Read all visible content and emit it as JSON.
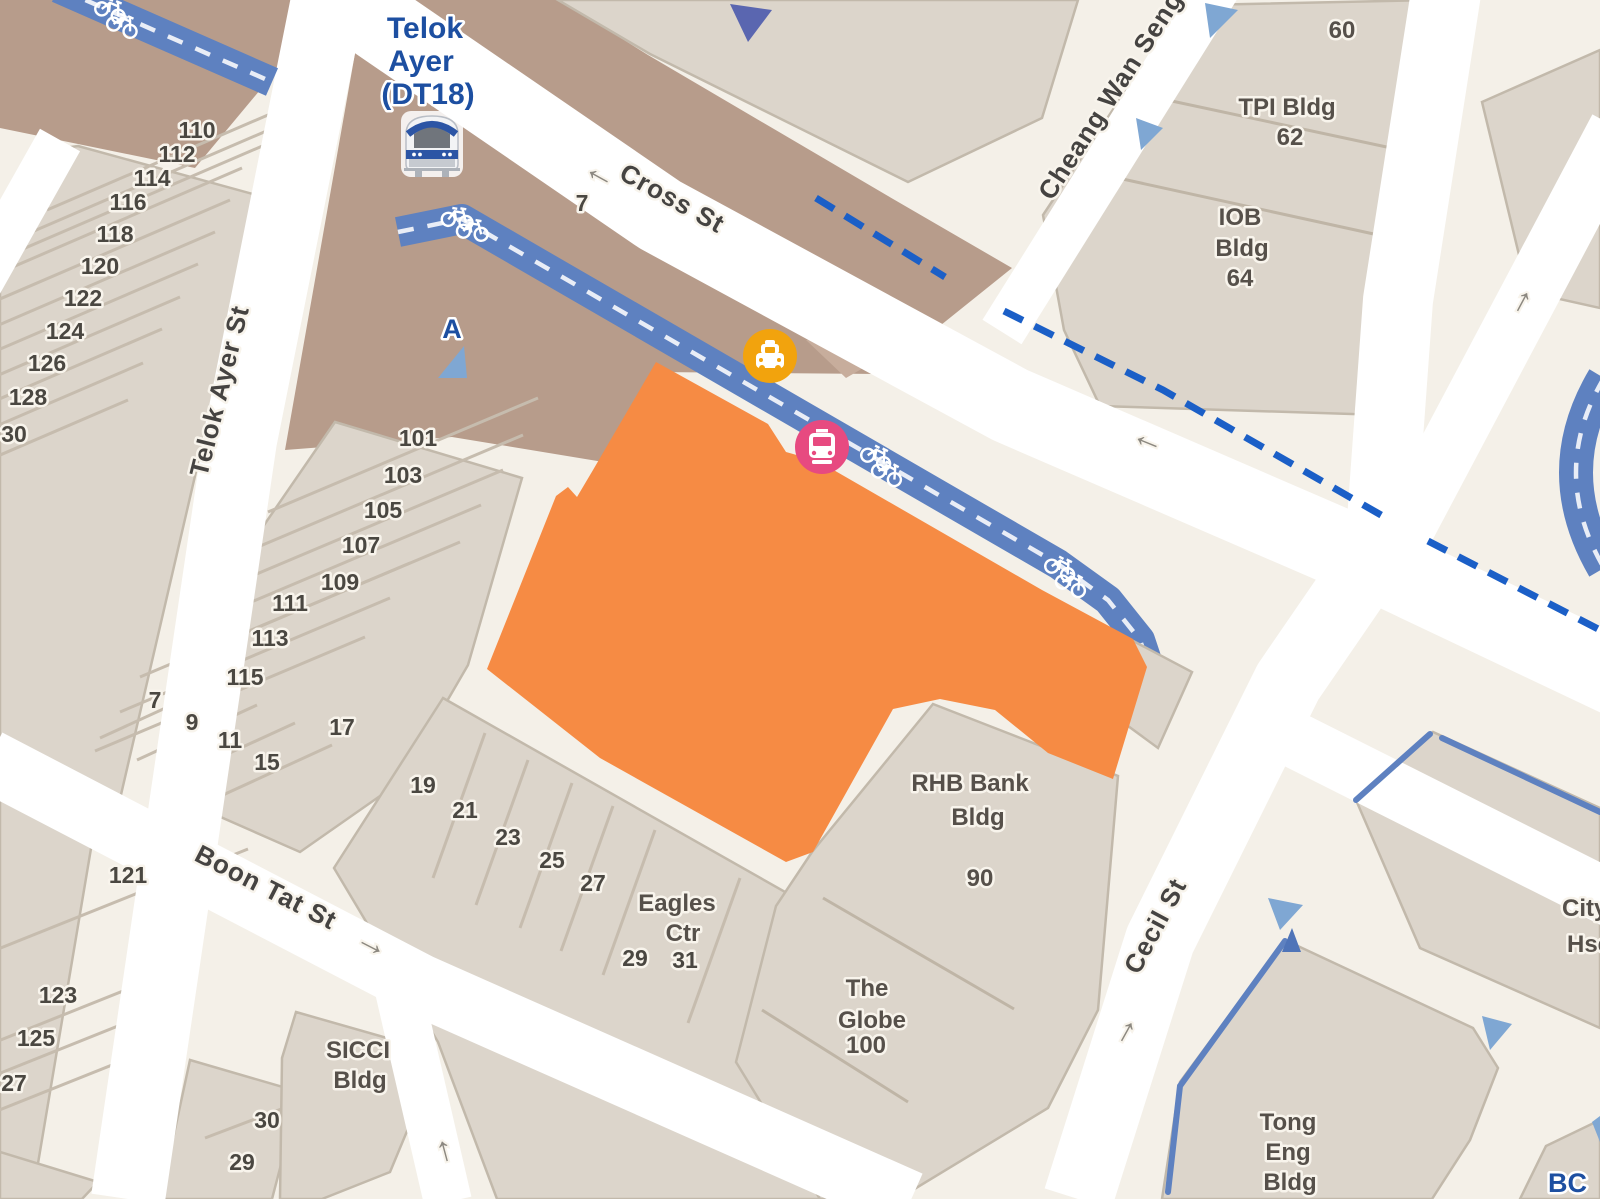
{
  "map": {
    "colors": {
      "background": "#F4F0E8",
      "road": "#FFFFFF",
      "pedestrian_zone": "#B79C8B",
      "building_fill": "#DCD5CB",
      "building_outline": "#C2B9AB",
      "highlight_parcel": "#F68B44",
      "cycleway": "#5E81C0",
      "rail_dashed_line": "#1B5FC7",
      "street_label": "#454341",
      "station_label": "#1D4FA1",
      "taxi_icon_bg": "#F2A30D",
      "bus_icon_bg": "#E74A80",
      "entrance_marker": "#7FA7D3"
    },
    "station": {
      "lines": [
        "Telok",
        "Ayer",
        "(DT18)"
      ]
    },
    "streets": {
      "telok_ayer": "Telok Ayer St",
      "cross": "Cross St",
      "cheang": "Cheang Wan Seng",
      "boon_tat": "Boon Tat St",
      "cecil": "Cecil St"
    },
    "cross_number": "7",
    "numbers_west": [
      "110",
      "112",
      "114",
      "116",
      "118",
      "120",
      "122",
      "124",
      "126",
      "128",
      "30"
    ],
    "numbers_east": [
      "101",
      "103",
      "105",
      "107",
      "109",
      "111",
      "113",
      "115"
    ],
    "numbers_small": [
      "7",
      "9",
      "11",
      "15",
      "17"
    ],
    "numbers_north_boon": [
      "19",
      "21",
      "23",
      "25",
      "27",
      "29",
      "31"
    ],
    "numbers_south_boon": [
      "121",
      "123",
      "125",
      "27",
      "30",
      "29"
    ],
    "buildings": {
      "b60": [
        "60"
      ],
      "tpi": [
        "TPI Bldg",
        "62"
      ],
      "iob": [
        "IOB",
        "Bldg",
        "64"
      ],
      "rhb": [
        "RHB Bank",
        "Bldg",
        "90"
      ],
      "globe": [
        "The",
        "Globe",
        "100"
      ],
      "eagles": [
        "Eagles",
        "Ctr"
      ],
      "sicci": [
        "SICCI",
        "Bldg"
      ],
      "tong_eng": [
        "Tong",
        "Eng",
        "Bldg"
      ],
      "city_hse": [
        "City",
        "Hse"
      ],
      "partial_bottom_right": "BC"
    },
    "markers": {
      "exit_a": "A"
    },
    "arrows": {
      "left": "←",
      "right": "→",
      "up": "↑"
    }
  }
}
